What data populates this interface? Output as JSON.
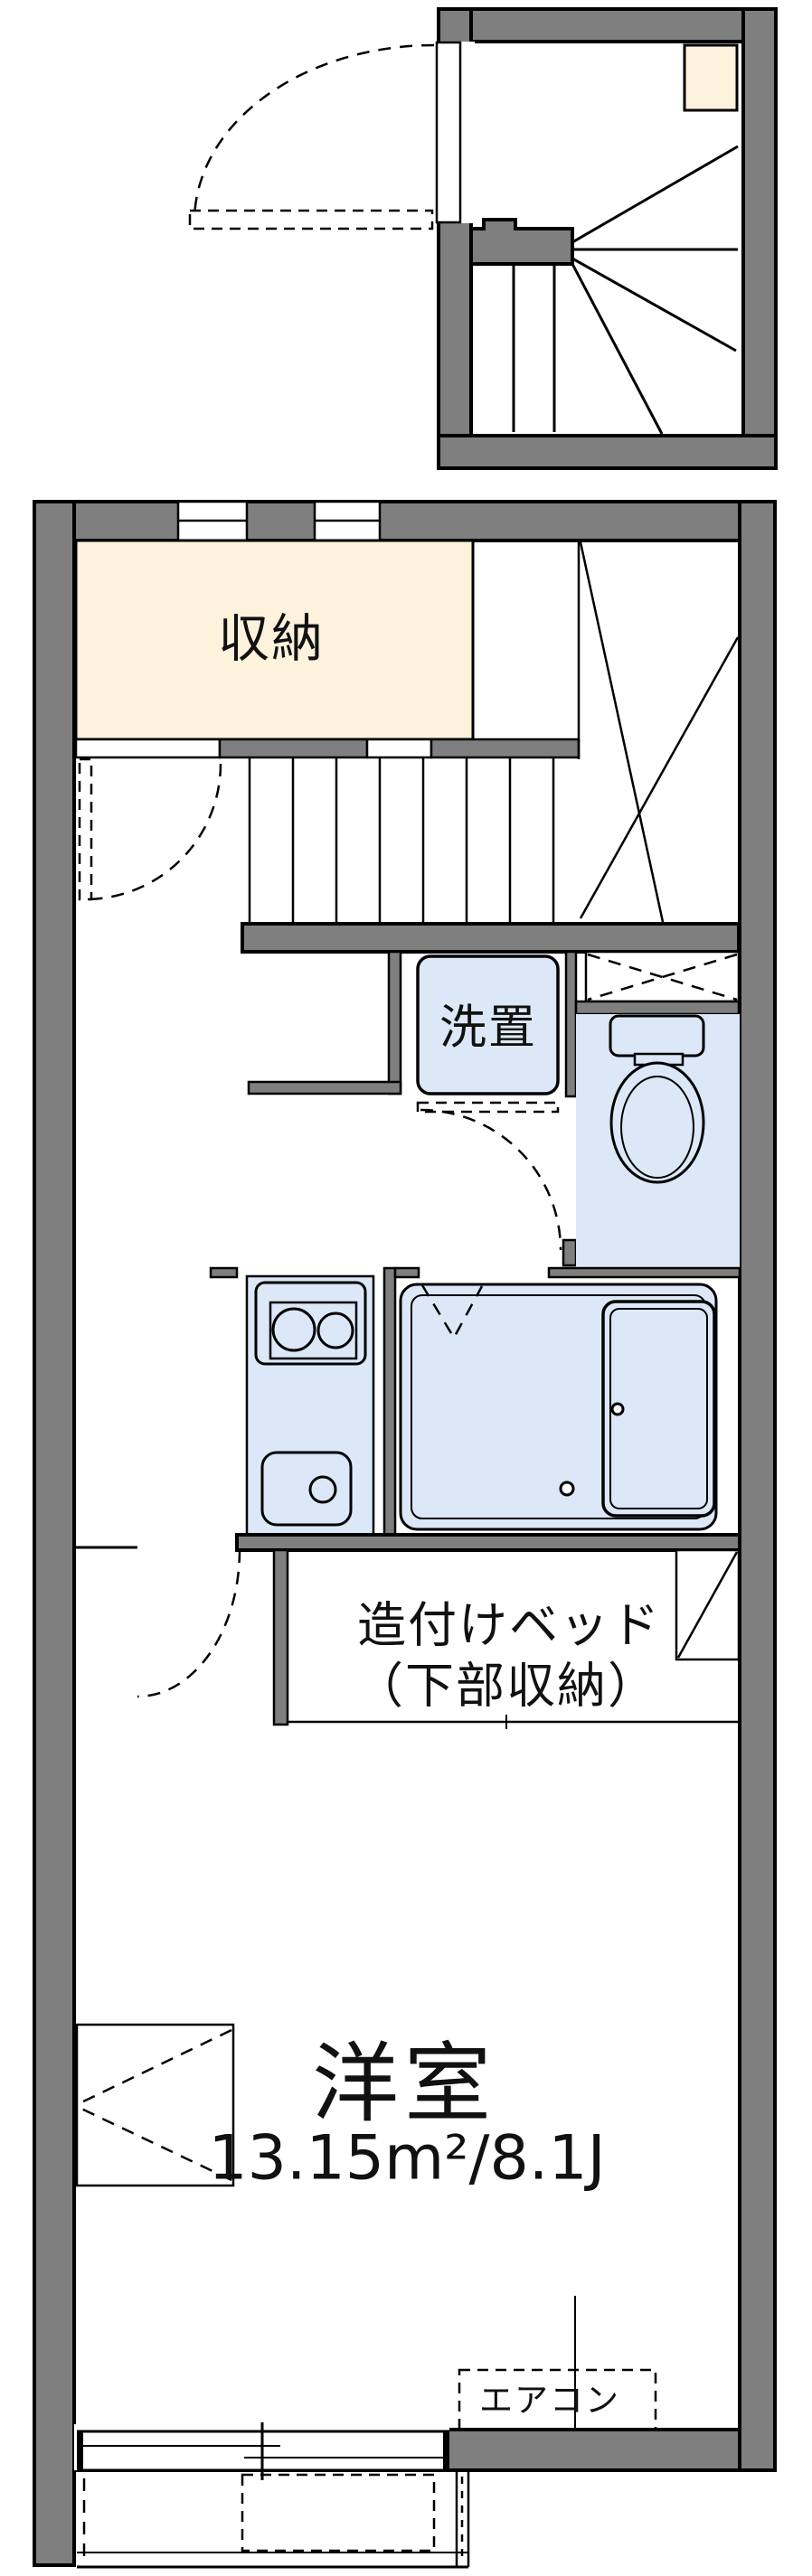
{
  "plan_title": "apartment floor plan",
  "rooms": {
    "storage": {
      "label": "収納"
    },
    "laundry": {
      "label": "洗置"
    },
    "bed": {
      "line1": "造付けベッド",
      "line2": "（下部収納）"
    },
    "western_room": {
      "label": "洋室",
      "area": "13.15m²/8.1J"
    },
    "aircon": {
      "label": "エアコン"
    }
  },
  "colors": {
    "wall": "#7f7f7f",
    "line": "#000000",
    "storage_fill": "#fdf2dc",
    "fixture_fill": "#dce8f7",
    "bg": "#ffffff"
  }
}
